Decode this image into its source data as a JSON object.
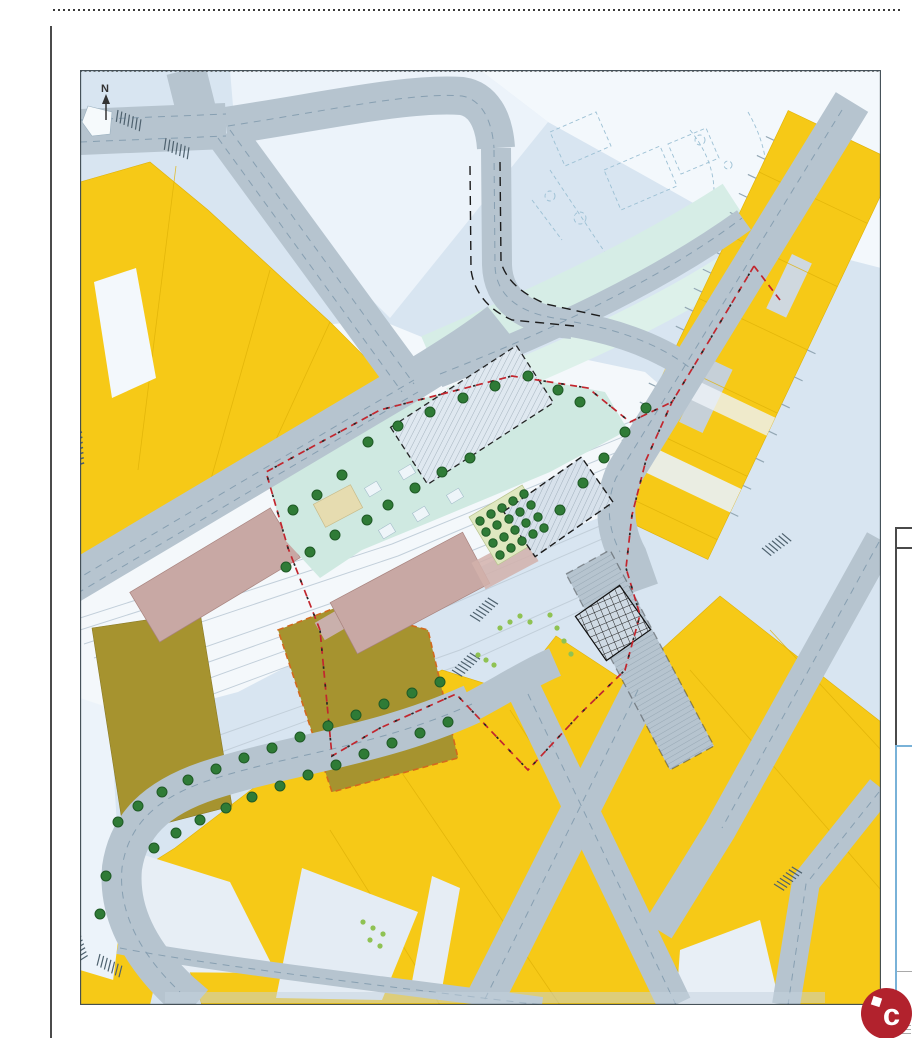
{
  "page": {
    "kind": "scanned urban plan sheet"
  },
  "map": {
    "north_label": "N",
    "palette": {
      "bg": "#d8e5f1",
      "pale": "#ecf3fa",
      "pale2": "#f3f8fc",
      "whiteband": "#f4f8fb",
      "road": "#b6c4cf",
      "lane": "#7f99ac",
      "yellow": "#f6c917",
      "yellowline": "#dfb108",
      "olive": "#a6932f",
      "oliveline": "#8a7a26",
      "rose": "#c8a8a4",
      "roseline": "#a8837e",
      "plaza": "#cfe9e1",
      "teal": "#d6ede6",
      "teal2": "#ddf1ea",
      "beige": "#e6dcb0",
      "beigeline": "#c7bb8a",
      "orchardbg": "#dfe8c0",
      "tree": "#2f7b36",
      "treeline": "#1f5a26",
      "bush": "#8fc253",
      "red": "#c2262e",
      "orange": "#d2691e",
      "dashblack": "#262626",
      "rail": "#c2cfda",
      "border": "#3e4a52",
      "squares": "#eef5f9",
      "squaresline": "#a4bdca",
      "logobg": "#b2222d",
      "panelline": "#4a4a4a",
      "panelblue": "#79b2d8"
    },
    "trees": {
      "plaza": [
        [
          288,
          372
        ],
        [
          318,
          356
        ],
        [
          350,
          342
        ],
        [
          383,
          328
        ],
        [
          415,
          316
        ],
        [
          448,
          306
        ],
        [
          262,
          405
        ],
        [
          237,
          425
        ],
        [
          213,
          440
        ],
        [
          255,
          465
        ],
        [
          230,
          482
        ],
        [
          206,
          497
        ],
        [
          308,
          435
        ],
        [
          287,
          450
        ],
        [
          335,
          418
        ],
        [
          362,
          402
        ],
        [
          390,
          388
        ],
        [
          478,
          320
        ],
        [
          500,
          332
        ]
      ],
      "corridor_ne": [
        [
          503,
          413
        ],
        [
          524,
          388
        ],
        [
          545,
          362
        ],
        [
          566,
          338
        ],
        [
          480,
          440
        ]
      ],
      "avenue_nw": [
        [
          360,
          612
        ],
        [
          332,
          623
        ],
        [
          304,
          634
        ],
        [
          276,
          645
        ],
        [
          248,
          656
        ],
        [
          220,
          667
        ],
        [
          192,
          678
        ],
        [
          164,
          688
        ],
        [
          136,
          699
        ],
        [
          108,
          710
        ],
        [
          82,
          722
        ],
        [
          58,
          736
        ],
        [
          38,
          752
        ]
      ],
      "avenue_se": [
        [
          368,
          652
        ],
        [
          340,
          663
        ],
        [
          312,
          673
        ],
        [
          284,
          684
        ],
        [
          256,
          695
        ],
        [
          228,
          705
        ],
        [
          200,
          716
        ],
        [
          172,
          727
        ],
        [
          146,
          738
        ],
        [
          120,
          750
        ],
        [
          96,
          763
        ],
        [
          74,
          778
        ]
      ],
      "west": [
        [
          26,
          806
        ],
        [
          20,
          844
        ]
      ]
    },
    "orchard_trees": [
      [
        400,
        451
      ],
      [
        411,
        444
      ],
      [
        422,
        438
      ],
      [
        433,
        431
      ],
      [
        444,
        424
      ],
      [
        406,
        462
      ],
      [
        417,
        455
      ],
      [
        429,
        449
      ],
      [
        440,
        442
      ],
      [
        451,
        435
      ],
      [
        413,
        473
      ],
      [
        424,
        467
      ],
      [
        435,
        460
      ],
      [
        446,
        453
      ],
      [
        458,
        447
      ],
      [
        420,
        485
      ],
      [
        431,
        478
      ],
      [
        442,
        471
      ],
      [
        453,
        464
      ],
      [
        464,
        458
      ]
    ],
    "bushes": [
      [
        470,
        545
      ],
      [
        477,
        558
      ],
      [
        484,
        571
      ],
      [
        491,
        584
      ],
      [
        420,
        558
      ],
      [
        430,
        552
      ],
      [
        440,
        546
      ],
      [
        450,
        552
      ],
      [
        398,
        585
      ],
      [
        406,
        590
      ],
      [
        414,
        595
      ],
      [
        283,
        852
      ],
      [
        293,
        858
      ],
      [
        303,
        864
      ],
      [
        290,
        870
      ],
      [
        300,
        876
      ]
    ]
  },
  "logo": {
    "text": "c"
  }
}
